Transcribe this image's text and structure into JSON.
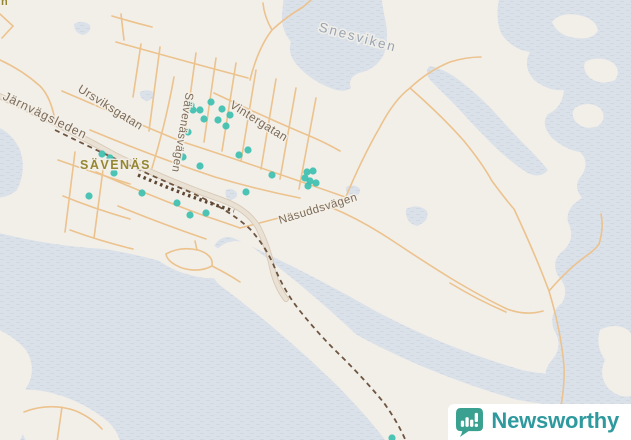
{
  "map": {
    "street_labels": [
      {
        "text": "Järnvägsleden",
        "x": 2,
        "y": 99,
        "rotate": 26,
        "size": 12.5,
        "color": "label_street",
        "spacing": 0.8
      },
      {
        "text": "Ursviksgatan",
        "x": 77,
        "y": 91,
        "rotate": 32,
        "size": 12,
        "color": "label_street",
        "spacing": 0.4
      },
      {
        "text": "Sävenäsvägen",
        "x": 186,
        "y": 92,
        "rotate": 100,
        "size": 11.5,
        "color": "label_street",
        "spacing": 0.4
      },
      {
        "text": "Vintergatan",
        "x": 229,
        "y": 107,
        "rotate": 32,
        "size": 12,
        "color": "label_street",
        "spacing": 0.4
      },
      {
        "text": "Näsuddsvägen",
        "x": 280,
        "y": 224,
        "rotate": -17,
        "size": 11.5,
        "color": "label_street",
        "spacing": 0.4
      }
    ],
    "place_labels": [
      {
        "text": "SÄVENÄS",
        "x": 80,
        "y": 169,
        "rotate": 0,
        "size": 12.5,
        "color": "label_place",
        "spacing": 1.5
      },
      {
        "text": "n",
        "x": 1,
        "y": 5,
        "rotate": 0,
        "size": 11,
        "color": "label_place",
        "spacing": 0
      }
    ],
    "water_labels": [
      {
        "text": "Snesviken",
        "x": 318,
        "y": 31,
        "rotate": 15,
        "size": 13.5,
        "color": "label_water",
        "spacing": 2
      }
    ],
    "markers": {
      "color": "#3ec0b0",
      "radius": 3.6,
      "points": [
        [
          211,
          102
        ],
        [
          191,
          105
        ],
        [
          193,
          110
        ],
        [
          200,
          110
        ],
        [
          222,
          109
        ],
        [
          230,
          115
        ],
        [
          204,
          119
        ],
        [
          218,
          120
        ],
        [
          226,
          126
        ],
        [
          188,
          132
        ],
        [
          183,
          157
        ],
        [
          200,
          166
        ],
        [
          239,
          155
        ],
        [
          248,
          150
        ],
        [
          272,
          175
        ],
        [
          246,
          192
        ],
        [
          307,
          172
        ],
        [
          313,
          171
        ],
        [
          305,
          178
        ],
        [
          310,
          181
        ],
        [
          316,
          183
        ],
        [
          308,
          186
        ],
        [
          102,
          154
        ],
        [
          110,
          158
        ],
        [
          114,
          173
        ],
        [
          89,
          196
        ],
        [
          142,
          193
        ],
        [
          177,
          203
        ],
        [
          190,
          215
        ],
        [
          206,
          213
        ],
        [
          392,
          438
        ]
      ]
    },
    "palette": {
      "land": "#f2efe9",
      "water": "#dbe1e9",
      "water_line": "#d1d8e2",
      "road_minor": "#ecc28d",
      "road_major_fill": "#eae1d5",
      "road_major_casing": "#d8c9b6",
      "railway": "#6e5541",
      "railway_station": "#5d4733",
      "label_street": "#7d6c59",
      "label_place": "#958731",
      "label_water": "#9aa4b0"
    }
  },
  "branding": {
    "name": "Newsworthy",
    "wordmark_color": "#2f9a9e",
    "icon_color": "#3aa191",
    "icon": "newsworthy-chart-bubble-icon",
    "background": "#ffffff"
  }
}
